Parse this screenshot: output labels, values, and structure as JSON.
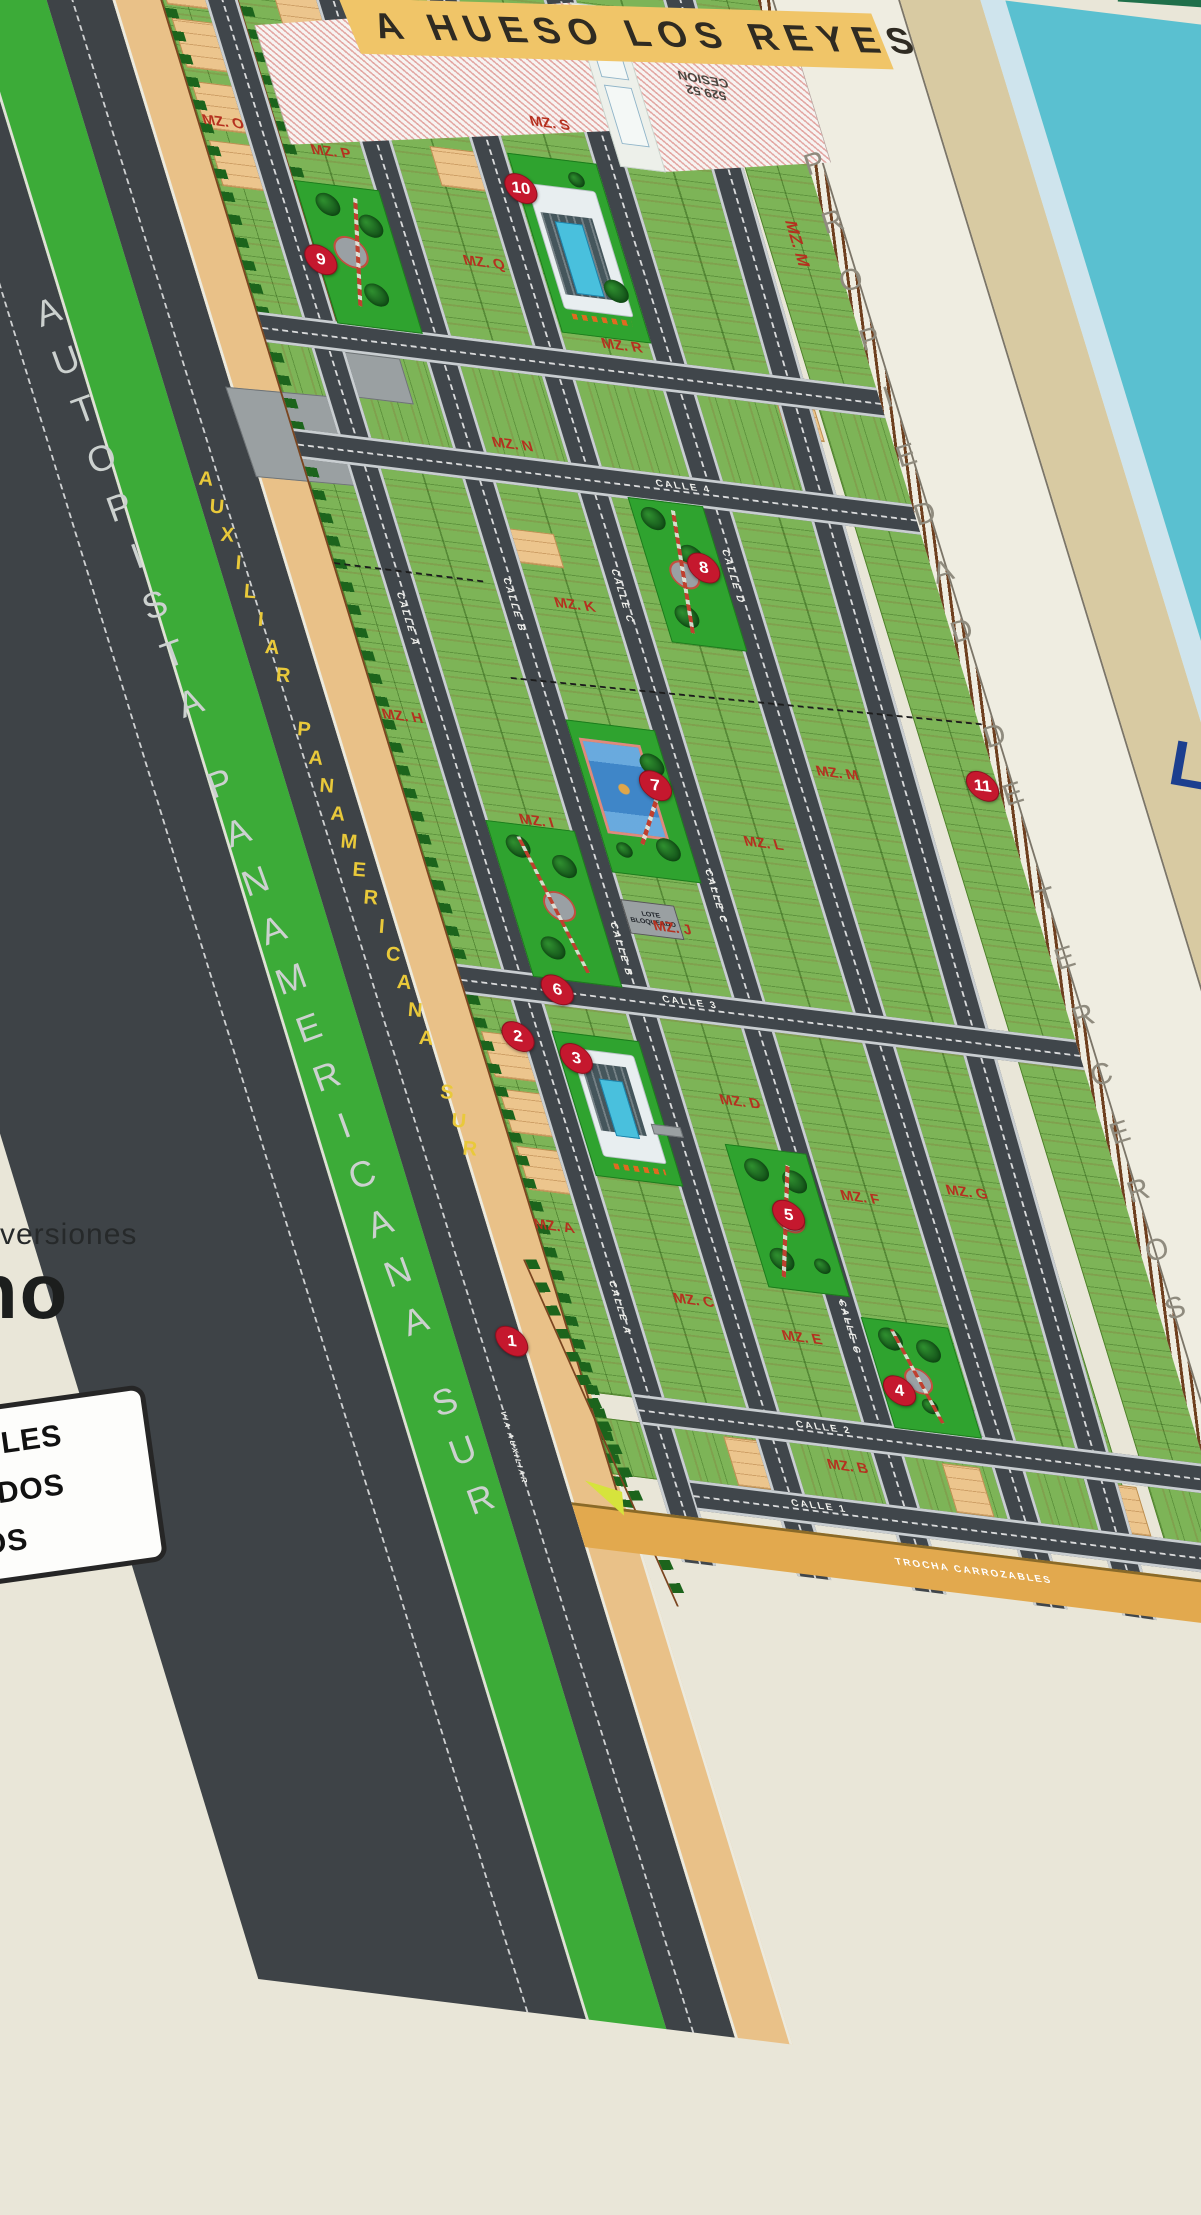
{
  "billboard": {
    "top_road_label": "A HUESO LOS REYES",
    "third_party_band": "PROPIEDAD DE TERCEROS",
    "partial_teal_letter": "L"
  },
  "cesion": {
    "label": "CESION",
    "value_large": "2377.71",
    "value_small": "529.52"
  },
  "highways": {
    "autopista": "AUTOPISTA PANAMERICANA SUR",
    "auxiliar": "AUXILIAR PANAMERICANA SUR",
    "via_auxiliar": "VIA AUXILIAR",
    "trocha": "TROCHA CARROZABLES"
  },
  "streets": {
    "calle_a": "CALLE A",
    "calle_b": "CALLE B",
    "calle_c": "CALLE C",
    "calle_d": "CALLE D",
    "calle_1": "CALLE 1",
    "calle_2": "CALLE 2",
    "calle_3": "CALLE 3",
    "calle_4": "CALLE 4"
  },
  "manzanas": {
    "a": "MZ. A",
    "b": "MZ. B",
    "c": "MZ. C",
    "d": "MZ. D",
    "e": "MZ. E",
    "f": "MZ. F",
    "g": "MZ. G",
    "h": "MZ. H",
    "i": "MZ. I",
    "j": "MZ. J",
    "k": "MZ. K",
    "l": "MZ. L",
    "m": "MZ. M",
    "n": "MZ. N",
    "o": "MZ. O",
    "p": "MZ. P",
    "q": "MZ. Q",
    "r": "MZ. R",
    "s": "MZ. S"
  },
  "markers": [
    "1",
    "2",
    "3",
    "4",
    "5",
    "6",
    "7",
    "8",
    "9",
    "10",
    "11"
  ],
  "special_lots": {
    "lote_bloqueado": "LOTE BLOQUEADO"
  },
  "logo": {
    "line1": "versiones",
    "line2": "no"
  },
  "legend_partial_labels": [
    "NIBLES",
    "EADOS",
    "DOS"
  ],
  "sample_lot_areas": [
    "182.40 m2",
    "23.80",
    "226.80 m2",
    "136.00 m2",
    "147.30 m2",
    "214.74 m2",
    "186.00 m2",
    "23.38",
    "185.66 m2",
    "188.36 m2",
    "182.22 m2",
    "22.57",
    "122.86 m2",
    "129.01 m2",
    "128.30 m2",
    "17.00",
    "16.02"
  ],
  "colors": {
    "billboard_bg": "#e9e6d8",
    "teal_panel": "#5ac0d0",
    "beige_band": "#d8caa2",
    "property_band": "#efede1",
    "asphalt": "#3e4347",
    "green_median": "#3cab38",
    "lot_green": "#7db457",
    "park_green": "#2fa32f",
    "lot_orange": "#ecc58d",
    "sidewalk_tan": "#e9c188",
    "trocha_tan": "#e2a94e",
    "marker_red": "#c5182e",
    "mz_label_red": "#b5301f",
    "hueso_band_yellow": "#f0c568",
    "auxiliar_text_yellow": "#e9c93a",
    "pool_blue": "#49c0dd",
    "court_blue": "#3f86c8"
  }
}
